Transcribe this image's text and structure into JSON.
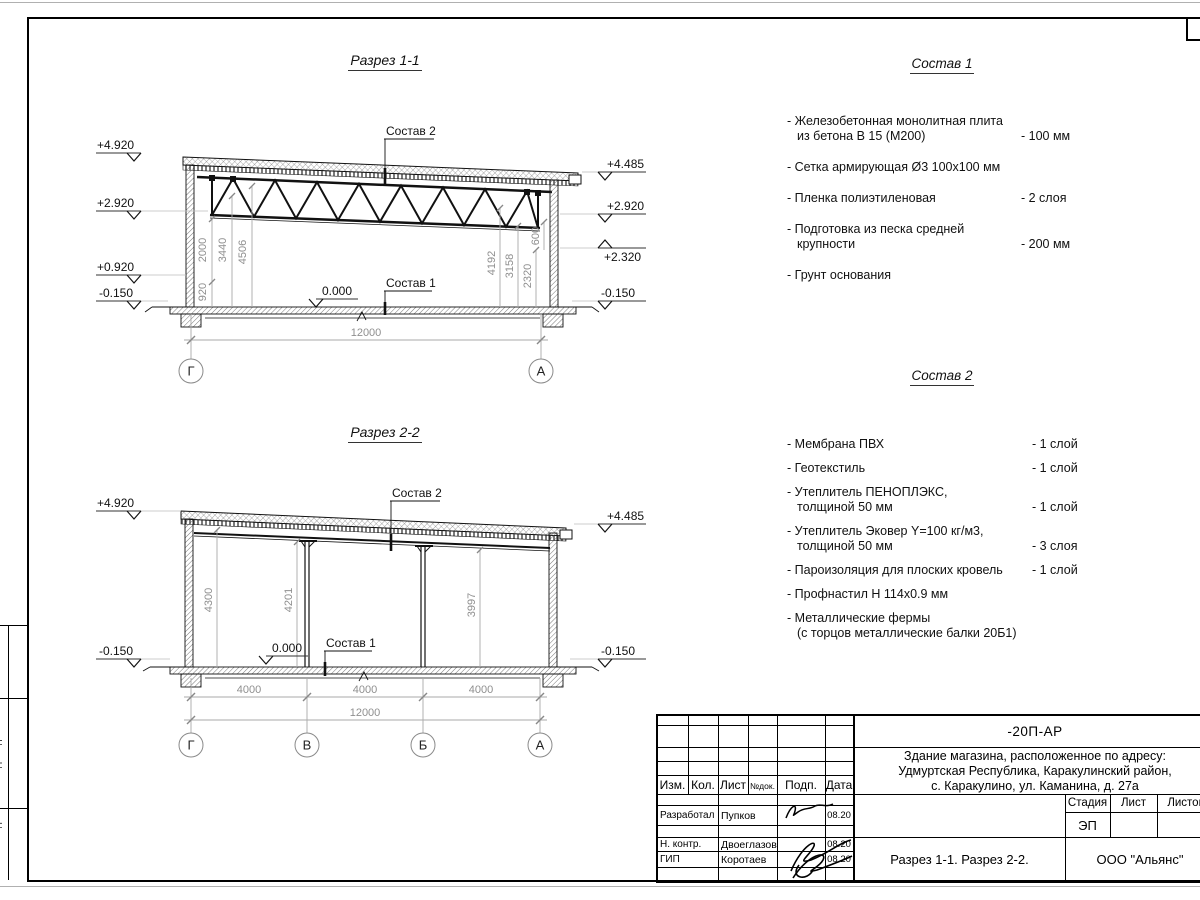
{
  "section1": {
    "title": "Разрез 1-1",
    "marks_left": [
      "+4.920",
      "+2.920",
      "+0.920",
      "-0.150"
    ],
    "marks_right": [
      "+4.485",
      "+2.920",
      "+2.320",
      "-0.150"
    ],
    "dims_left": [
      "920",
      "2000",
      "3440",
      "4506"
    ],
    "dims_right": [
      "4192",
      "3158",
      "2320",
      "600"
    ],
    "dim_total": "12000",
    "zero": "0.000",
    "sostav1_label": "Состав 1",
    "sostav2_label": "Состав 2",
    "axes": [
      "Г",
      "А"
    ]
  },
  "section2": {
    "title": "Разрез 2-2",
    "marks_left": [
      "+4.920",
      "-0.150"
    ],
    "marks_right": [
      "+4.485",
      "-0.150"
    ],
    "dims_inner": [
      "4300",
      "4201",
      "3997"
    ],
    "dims_bottom": [
      "4000",
      "4000",
      "4000"
    ],
    "dim_total": "12000",
    "zero": "0.000",
    "sostav1_label": "Состав 1",
    "sostav2_label": "Состав 2",
    "axes": [
      "Г",
      "В",
      "Б",
      "А"
    ]
  },
  "sostav1": {
    "title": "Состав 1",
    "items": [
      {
        "l1": "- Железобетонная монолитная плита",
        "l2": "из бетона В 15 (М200)",
        "v": "- 100 мм"
      },
      {
        "l1": "- Сетка армирующая Ø3 100х100 мм",
        "l2": "",
        "v": ""
      },
      {
        "l1": "- Пленка полиэтиленовая",
        "l2": "",
        "v": "-  2 слоя"
      },
      {
        "l1": "- Подготовка из песка средней",
        "l2": "крупности",
        "v": "- 200 мм"
      },
      {
        "l1": "- Грунт основания",
        "l2": "",
        "v": ""
      }
    ]
  },
  "sostav2": {
    "title": "Состав 2",
    "items": [
      {
        "l1": "- Мембрана ПВХ",
        "l2": "",
        "v": "- 1 слой"
      },
      {
        "l1": "- Геотекстиль",
        "l2": "",
        "v": "- 1 слой"
      },
      {
        "l1": "- Утеплитель ПЕНОПЛЭКС,",
        "l2": "толщиной 50 мм",
        "v": "- 1 слой"
      },
      {
        "l1": "- Утеплитель Эковер Y=100 кг/м3,",
        "l2": "толщиной 50 мм",
        "v": "- 3 слоя"
      },
      {
        "l1": "- Пароизоляция для плоских кровель",
        "l2": "",
        "v": "- 1 слой"
      },
      {
        "l1": "- Профнастил Н 114х0.9 мм",
        "l2": "",
        "v": ""
      },
      {
        "l1": "- Металлические фермы",
        "l2": "(с торцов металлические балки 20Б1)",
        "v": ""
      }
    ]
  },
  "titleblock": {
    "doc_number": "-20П-АР",
    "project": [
      "Здание магазина, расположенное по адресу:",
      "Удмуртская Республика, Каракулинский район,",
      "с. Каракулино, ул. Каманина, д. 27а"
    ],
    "header": {
      "izm": "Изм.",
      "kol": "Кол.",
      "list": "Лист",
      "ndok": "№док.",
      "podp": "Подп.",
      "data": "Дата"
    },
    "rows": [
      {
        "role": "Разработал",
        "name": "Пупков",
        "date": "08.20"
      },
      {
        "role": "Н. контр.",
        "name": "Двоеглазов",
        "date": "08.20"
      },
      {
        "role": "ГИП",
        "name": "Коротаев",
        "date": "08.20"
      }
    ],
    "stage_label": "Стадия",
    "list_label": "Лист",
    "listov_label": "Листов",
    "stage": "ЭП",
    "title": "Разрез 1-1. Разрез 2-2.",
    "company": "ООО \"Альянс\""
  },
  "side_strip": [
    "Взам. инв. №",
    "Подп. и дата",
    "Инв. № подл."
  ],
  "colors": {
    "line": "#111111",
    "dim_line": "#aaaaaa",
    "dim_text": "#8f8f8f",
    "frame": "#000000"
  }
}
